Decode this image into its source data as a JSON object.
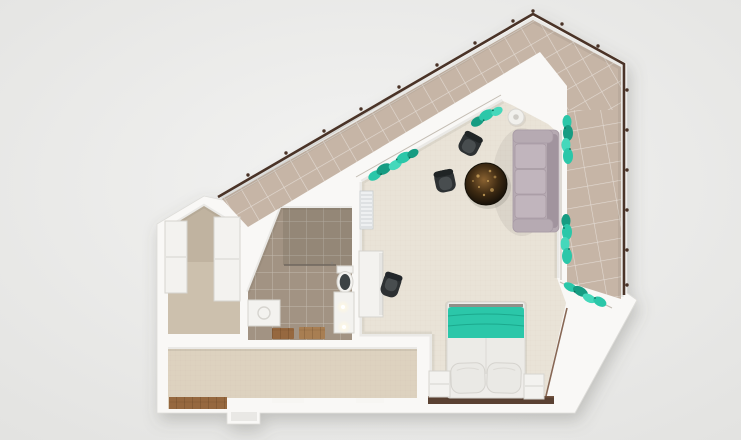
{
  "scene": {
    "kind": "apartment-floorplan-3d-render-top-view",
    "rooms": [
      {
        "name": "balcony-terrace"
      },
      {
        "name": "living-room"
      },
      {
        "name": "sleeping-area"
      },
      {
        "name": "bathroom"
      },
      {
        "name": "hallway"
      },
      {
        "name": "wardrobe-room"
      }
    ],
    "furniture": [
      {
        "name": "sofa"
      },
      {
        "name": "coffee-table"
      },
      {
        "name": "armchair"
      },
      {
        "name": "armchair"
      },
      {
        "name": "floor-lamp"
      },
      {
        "name": "office-desk"
      },
      {
        "name": "office-chair"
      },
      {
        "name": "ac-unit"
      },
      {
        "name": "double-bed"
      },
      {
        "name": "nightstand"
      },
      {
        "name": "nightstand"
      },
      {
        "name": "dresser"
      },
      {
        "name": "wardrobe"
      },
      {
        "name": "wardrobe"
      },
      {
        "name": "toilet"
      },
      {
        "name": "vanity"
      },
      {
        "name": "washing-machine"
      },
      {
        "name": "bath-mat"
      },
      {
        "name": "plant-box"
      }
    ],
    "palette": {
      "bg1": "#f3f3f2",
      "bg2": "#e3e3e1",
      "wall": "#f9f8f6",
      "wall_edge": "#deddd9",
      "balcony_tile": "#c6b5a6",
      "railing": "#4a3327",
      "carpet": "#e9e3d7",
      "closet_floor": "#ccc0ad",
      "bath_tile": "#a29383",
      "hall_floor": "#ddd2bf",
      "wood": "#96683f",
      "teal": "#2bc7a9",
      "teal_dark": "#169c82",
      "teal_light": "#45d8bb",
      "plant_dot": "#0b6e59",
      "sofa": "#b6aab2",
      "sofa_dark": "#a1949e",
      "sofa_light": "#c1b5bd",
      "furniture_white": "#f3f2ef",
      "furniture_edge": "#d6d4cf",
      "chair_dark": "#2d3133",
      "chair_mid": "#484d4f",
      "table_c1": "#8a6231",
      "table_c2": "#3f2b13",
      "table_c3": "#140f08",
      "gold": "#cda45c",
      "frame_brown": "#7a5742",
      "dresser": "#5a4132",
      "glass": "#6f675e"
    }
  }
}
